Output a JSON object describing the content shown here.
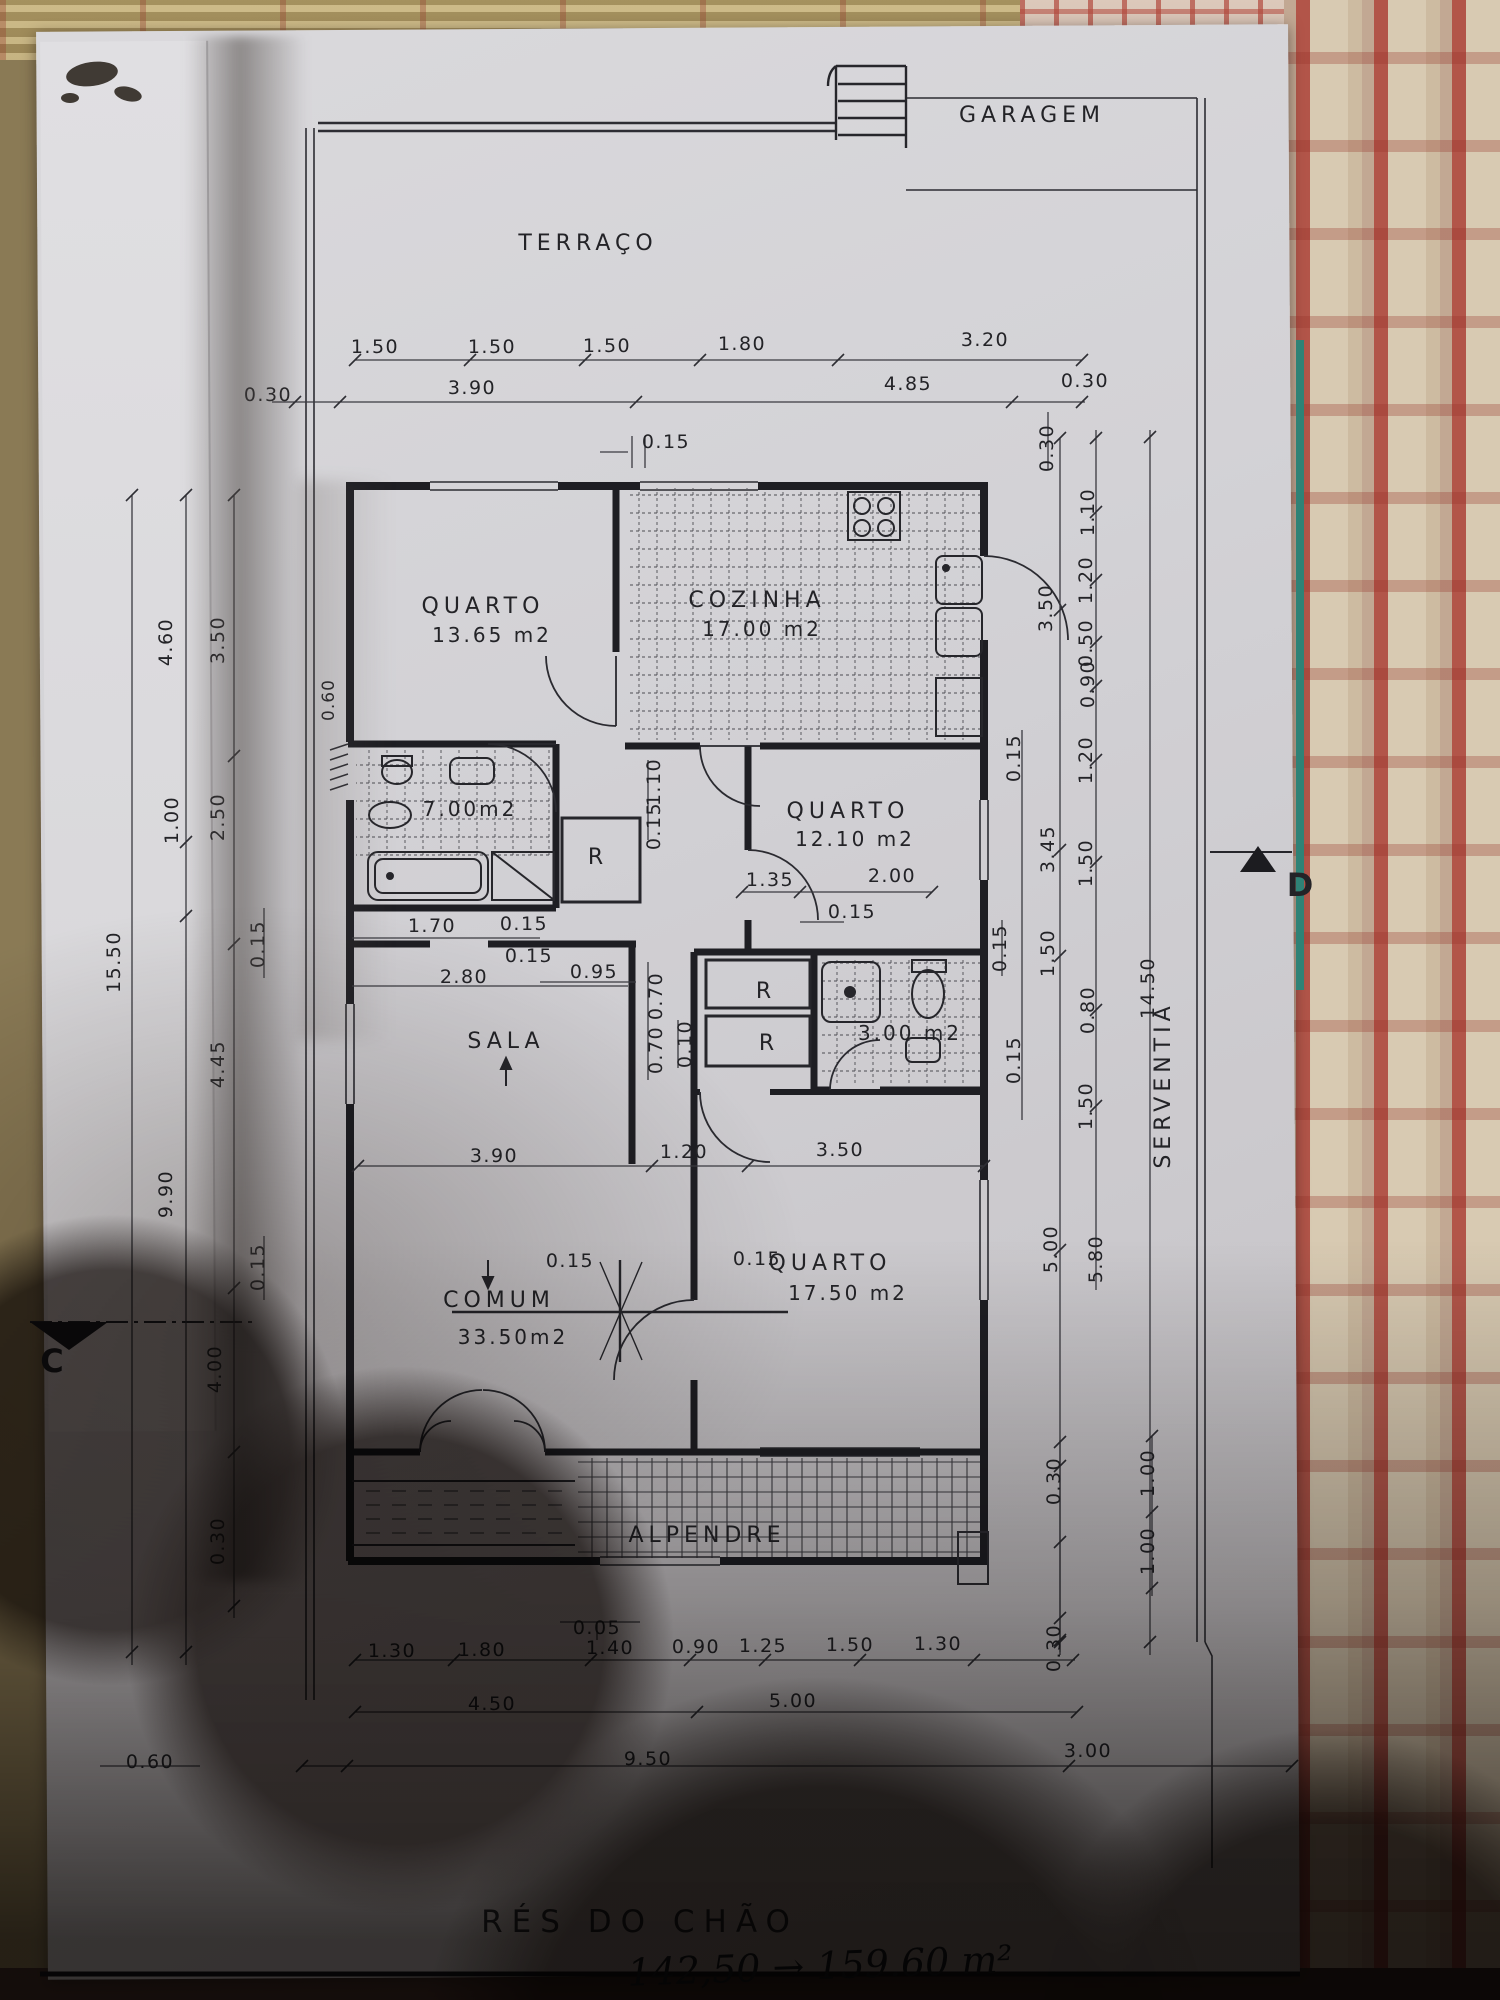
{
  "photo": {
    "description": "photocopied architectural ground-floor plan lying on a patterned tablecloth, large hand shadow over lower half",
    "title": "RÉS DO CHÃO",
    "handwritten_note": "142,50 → 159.60 m²"
  },
  "plan": {
    "rooms": [
      {
        "name": "GARAGEM"
      },
      {
        "name": "TERRAÇO"
      },
      {
        "name": "QUARTO",
        "area": "13.65 m2"
      },
      {
        "name": "COZINHA",
        "area": "17.00 m2"
      },
      {
        "name": "WC",
        "area": "7.00m2"
      },
      {
        "name": "QUARTO",
        "area": "12.10 m2"
      },
      {
        "name": "SALA"
      },
      {
        "name": "COMUM",
        "area": "33.50m2"
      },
      {
        "name": "QUARTO",
        "area": "17.50 m2"
      },
      {
        "name": "WC",
        "area": "3.00 m2"
      },
      {
        "name": "ALPENDRE"
      },
      {
        "name": "SERVENTIA"
      },
      {
        "name": "R",
        "note": "closet, appears 3 times"
      }
    ],
    "section_markers": [
      "C",
      "D"
    ],
    "labels": [
      {
        "n": "room-label-garagem",
        "t": "GARAGEM",
        "x": 1032,
        "y": 122,
        "c": "room"
      },
      {
        "n": "room-label-terraco",
        "t": "TERRAÇO",
        "x": 588,
        "y": 250,
        "c": "room"
      },
      {
        "n": "room-label-quarto-1",
        "t": "QUARTO",
        "x": 483,
        "y": 613,
        "c": "room"
      },
      {
        "n": "area-label-quarto-1",
        "t": "13.65 m2",
        "x": 492,
        "y": 642,
        "c": "area"
      },
      {
        "n": "room-label-cozinha",
        "t": "COZINHA",
        "x": 757,
        "y": 607,
        "c": "room"
      },
      {
        "n": "area-label-cozinha",
        "t": "17.00 m2",
        "x": 762,
        "y": 636,
        "c": "area"
      },
      {
        "n": "area-label-wc1",
        "t": "7.00m2",
        "x": 470,
        "y": 816,
        "c": "area"
      },
      {
        "n": "room-label-quarto-2",
        "t": "QUARTO",
        "x": 848,
        "y": 818,
        "c": "room"
      },
      {
        "n": "area-label-quarto-2",
        "t": "12.10 m2",
        "x": 855,
        "y": 846,
        "c": "area"
      },
      {
        "n": "closet-label-r1",
        "t": "R",
        "x": 598,
        "y": 864,
        "c": "room"
      },
      {
        "n": "room-label-sala",
        "t": "SALA",
        "x": 506,
        "y": 1048,
        "c": "room"
      },
      {
        "n": "closet-label-r2",
        "t": "R",
        "x": 766,
        "y": 998,
        "c": "room"
      },
      {
        "n": "closet-label-r3",
        "t": "R",
        "x": 769,
        "y": 1050,
        "c": "room"
      },
      {
        "n": "area-label-wc2",
        "t": "3.00 m2",
        "x": 910,
        "y": 1040,
        "c": "area"
      },
      {
        "n": "room-label-comum",
        "t": "COMUM",
        "x": 499,
        "y": 1307,
        "c": "room"
      },
      {
        "n": "area-label-comum",
        "t": "33.50m2",
        "x": 513,
        "y": 1344,
        "c": "area"
      },
      {
        "n": "room-label-quarto-3",
        "t": "QUARTO",
        "x": 830,
        "y": 1270,
        "c": "room"
      },
      {
        "n": "area-label-quarto-3",
        "t": "17.50 m2",
        "x": 848,
        "y": 1300,
        "c": "area"
      },
      {
        "n": "room-label-alpendre",
        "t": "ALPENDRE",
        "x": 707,
        "y": 1542,
        "c": "room"
      },
      {
        "n": "room-label-serventia",
        "t": "SERVENTIA",
        "x": 1170,
        "y": 1085,
        "r": -90,
        "c": "room"
      },
      {
        "n": "section-marker-c",
        "t": "C",
        "x": 52,
        "y": 1372,
        "c": "marker"
      },
      {
        "n": "section-marker-d",
        "t": "D",
        "x": 1300,
        "y": 896,
        "c": "marker"
      },
      {
        "n": "dim-label",
        "t": "1.50",
        "x": 375,
        "y": 353,
        "c": "dim"
      },
      {
        "n": "dim-label",
        "t": "1.50",
        "x": 492,
        "y": 353,
        "c": "dim"
      },
      {
        "n": "dim-label",
        "t": "1.50",
        "x": 607,
        "y": 352,
        "c": "dim"
      },
      {
        "n": "dim-label",
        "t": "1.80",
        "x": 742,
        "y": 350,
        "c": "dim"
      },
      {
        "n": "dim-label",
        "t": "3.20",
        "x": 985,
        "y": 346,
        "c": "dim"
      },
      {
        "n": "dim-label",
        "t": "0.30",
        "x": 268,
        "y": 401,
        "c": "dim"
      },
      {
        "n": "dim-label",
        "t": "3.90",
        "x": 472,
        "y": 394,
        "c": "dim"
      },
      {
        "n": "dim-label",
        "t": "4.85",
        "x": 908,
        "y": 390,
        "c": "dim"
      },
      {
        "n": "dim-label",
        "t": "0.30",
        "x": 1085,
        "y": 387,
        "c": "dim"
      },
      {
        "n": "dim-label",
        "t": "0.15",
        "x": 666,
        "y": 448,
        "c": "dim"
      },
      {
        "n": "dim-label",
        "t": "0.30",
        "x": 1053,
        "y": 448,
        "r": -90,
        "c": "dim"
      },
      {
        "n": "dim-label",
        "t": "4.60",
        "x": 172,
        "y": 642,
        "r": -90,
        "c": "dim"
      },
      {
        "n": "dim-label",
        "t": "3.50",
        "x": 224,
        "y": 640,
        "r": -90,
        "c": "dim"
      },
      {
        "n": "dim-label",
        "t": "0.60",
        "x": 334,
        "y": 700,
        "r": -90,
        "c": "s17"
      },
      {
        "n": "dim-label",
        "t": "1.00",
        "x": 178,
        "y": 820,
        "r": -90,
        "c": "dim"
      },
      {
        "n": "dim-label",
        "t": "2.50",
        "x": 224,
        "y": 817,
        "r": -90,
        "c": "dim"
      },
      {
        "n": "dim-label",
        "t": "15.50",
        "x": 120,
        "y": 962,
        "r": -90,
        "c": "dim"
      },
      {
        "n": "dim-label",
        "t": "0.15",
        "x": 264,
        "y": 944,
        "r": -90,
        "c": "dim"
      },
      {
        "n": "dim-label",
        "t": "4.45",
        "x": 224,
        "y": 1064,
        "r": -90,
        "c": "dim"
      },
      {
        "n": "dim-label",
        "t": "9.90",
        "x": 172,
        "y": 1194,
        "r": -90,
        "c": "dim"
      },
      {
        "n": "dim-label",
        "t": "0.15",
        "x": 264,
        "y": 1267,
        "r": -90,
        "c": "dim"
      },
      {
        "n": "dim-label",
        "t": "4.00",
        "x": 221,
        "y": 1369,
        "r": -90,
        "c": "dim"
      },
      {
        "n": "dim-label",
        "t": "0.30",
        "x": 224,
        "y": 1541,
        "r": -90,
        "c": "dim"
      },
      {
        "n": "dim-label",
        "t": "0.60",
        "x": 150,
        "y": 1768,
        "c": "dim"
      },
      {
        "n": "dim-label",
        "t": "1.10",
        "x": 1094,
        "y": 512,
        "r": -90,
        "c": "dim"
      },
      {
        "n": "dim-label",
        "t": "1.20",
        "x": 1092,
        "y": 580,
        "r": -90,
        "c": "dim"
      },
      {
        "n": "dim-label",
        "t": "3.50",
        "x": 1052,
        "y": 608,
        "r": -90,
        "c": "dim"
      },
      {
        "n": "dim-label",
        "t": "0.50",
        "x": 1092,
        "y": 643,
        "r": -90,
        "c": "dim"
      },
      {
        "n": "dim-label",
        "t": "0.90",
        "x": 1094,
        "y": 684,
        "r": -90,
        "c": "dim"
      },
      {
        "n": "dim-label",
        "t": "1.20",
        "x": 1092,
        "y": 760,
        "r": -90,
        "c": "dim"
      },
      {
        "n": "dim-label",
        "t": "0.15",
        "x": 1020,
        "y": 758,
        "r": -90,
        "c": "dim"
      },
      {
        "n": "dim-label",
        "t": "3.45",
        "x": 1054,
        "y": 849,
        "r": -90,
        "c": "dim"
      },
      {
        "n": "dim-label",
        "t": "1.50",
        "x": 1092,
        "y": 863,
        "r": -90,
        "c": "dim"
      },
      {
        "n": "dim-label",
        "t": "1.50",
        "x": 1054,
        "y": 953,
        "r": -90,
        "c": "dim"
      },
      {
        "n": "dim-label",
        "t": "0.80",
        "x": 1094,
        "y": 1010,
        "r": -90,
        "c": "dim"
      },
      {
        "n": "dim-label",
        "t": "0.15",
        "x": 1020,
        "y": 1060,
        "r": -90,
        "c": "dim"
      },
      {
        "n": "dim-label",
        "t": "1.50",
        "x": 1092,
        "y": 1106,
        "r": -90,
        "c": "dim"
      },
      {
        "n": "dim-label",
        "t": "14.50",
        "x": 1154,
        "y": 988,
        "r": -90,
        "c": "dim"
      },
      {
        "n": "dim-label",
        "t": "5.00",
        "x": 1057,
        "y": 1249,
        "r": -90,
        "c": "dim"
      },
      {
        "n": "dim-label",
        "t": "5.80",
        "x": 1102,
        "y": 1259,
        "r": -90,
        "c": "dim"
      },
      {
        "n": "dim-label",
        "t": "0.30",
        "x": 1060,
        "y": 1481,
        "r": -90,
        "c": "dim"
      },
      {
        "n": "dim-label",
        "t": "1.00",
        "x": 1154,
        "y": 1473,
        "r": -90,
        "c": "dim"
      },
      {
        "n": "dim-label",
        "t": "1.00",
        "x": 1154,
        "y": 1551,
        "r": -90,
        "c": "dim"
      },
      {
        "n": "dim-label",
        "t": "0.30",
        "x": 1060,
        "y": 1648,
        "r": -90,
        "c": "dim"
      },
      {
        "n": "dim-label",
        "t": "1.10",
        "x": 660,
        "y": 782,
        "r": -90,
        "c": "dim"
      },
      {
        "n": "dim-label",
        "t": "0.15",
        "x": 660,
        "y": 826,
        "r": -90,
        "c": "dim"
      },
      {
        "n": "dim-label",
        "t": "1.70",
        "x": 432,
        "y": 932,
        "c": "dim"
      },
      {
        "n": "dim-label",
        "t": "0.15",
        "x": 524,
        "y": 930,
        "c": "dim"
      },
      {
        "n": "dim-label",
        "t": "0.15",
        "x": 529,
        "y": 962,
        "c": "dim"
      },
      {
        "n": "dim-label",
        "t": "2.80",
        "x": 464,
        "y": 983,
        "c": "dim"
      },
      {
        "n": "dim-label",
        "t": "0.95",
        "x": 594,
        "y": 978,
        "c": "dim"
      },
      {
        "n": "dim-label",
        "t": "0.70",
        "x": 662,
        "y": 996,
        "r": -90,
        "c": "dim"
      },
      {
        "n": "dim-label",
        "t": "0.70",
        "x": 662,
        "y": 1050,
        "r": -90,
        "c": "dim"
      },
      {
        "n": "dim-label",
        "t": "0.10",
        "x": 691,
        "y": 1044,
        "r": -90,
        "c": "dim"
      },
      {
        "n": "dim-label",
        "t": "1.35",
        "x": 770,
        "y": 886,
        "c": "dim"
      },
      {
        "n": "dim-label",
        "t": "2.00",
        "x": 892,
        "y": 882,
        "c": "dim"
      },
      {
        "n": "dim-label",
        "t": "0.15",
        "x": 852,
        "y": 918,
        "c": "dim"
      },
      {
        "n": "dim-label",
        "t": "0.15",
        "x": 1006,
        "y": 948,
        "r": -90,
        "c": "dim"
      },
      {
        "n": "dim-label",
        "t": "3.90",
        "x": 494,
        "y": 1162,
        "c": "dim"
      },
      {
        "n": "dim-label",
        "t": "1.20",
        "x": 684,
        "y": 1158,
        "c": "dim"
      },
      {
        "n": "dim-label",
        "t": "3.50",
        "x": 840,
        "y": 1156,
        "c": "dim"
      },
      {
        "n": "dim-label",
        "t": "0.15",
        "x": 570,
        "y": 1267,
        "c": "dim"
      },
      {
        "n": "dim-label",
        "t": "0.15",
        "x": 757,
        "y": 1265,
        "c": "dim"
      },
      {
        "n": "dim-label",
        "t": "0.05",
        "x": 597,
        "y": 1634,
        "c": "dim"
      },
      {
        "n": "dim-label",
        "t": "1.30",
        "x": 392,
        "y": 1657,
        "c": "dim"
      },
      {
        "n": "dim-label",
        "t": "1.80",
        "x": 482,
        "y": 1656,
        "c": "dim"
      },
      {
        "n": "dim-label",
        "t": "1.40",
        "x": 610,
        "y": 1654,
        "c": "dim"
      },
      {
        "n": "dim-label",
        "t": "0.90",
        "x": 696,
        "y": 1653,
        "c": "dim"
      },
      {
        "n": "dim-label",
        "t": "1.25",
        "x": 763,
        "y": 1652,
        "c": "dim"
      },
      {
        "n": "dim-label",
        "t": "1.50",
        "x": 850,
        "y": 1651,
        "c": "dim"
      },
      {
        "n": "dim-label",
        "t": "1.30",
        "x": 938,
        "y": 1650,
        "c": "dim"
      },
      {
        "n": "dim-label",
        "t": "4.50",
        "x": 492,
        "y": 1710,
        "c": "dim"
      },
      {
        "n": "dim-label",
        "t": "5.00",
        "x": 793,
        "y": 1707,
        "c": "dim"
      },
      {
        "n": "dim-label",
        "t": "9.50",
        "x": 648,
        "y": 1765,
        "c": "dim"
      },
      {
        "n": "dim-label",
        "t": "3.00",
        "x": 1088,
        "y": 1757,
        "c": "dim"
      }
    ]
  }
}
